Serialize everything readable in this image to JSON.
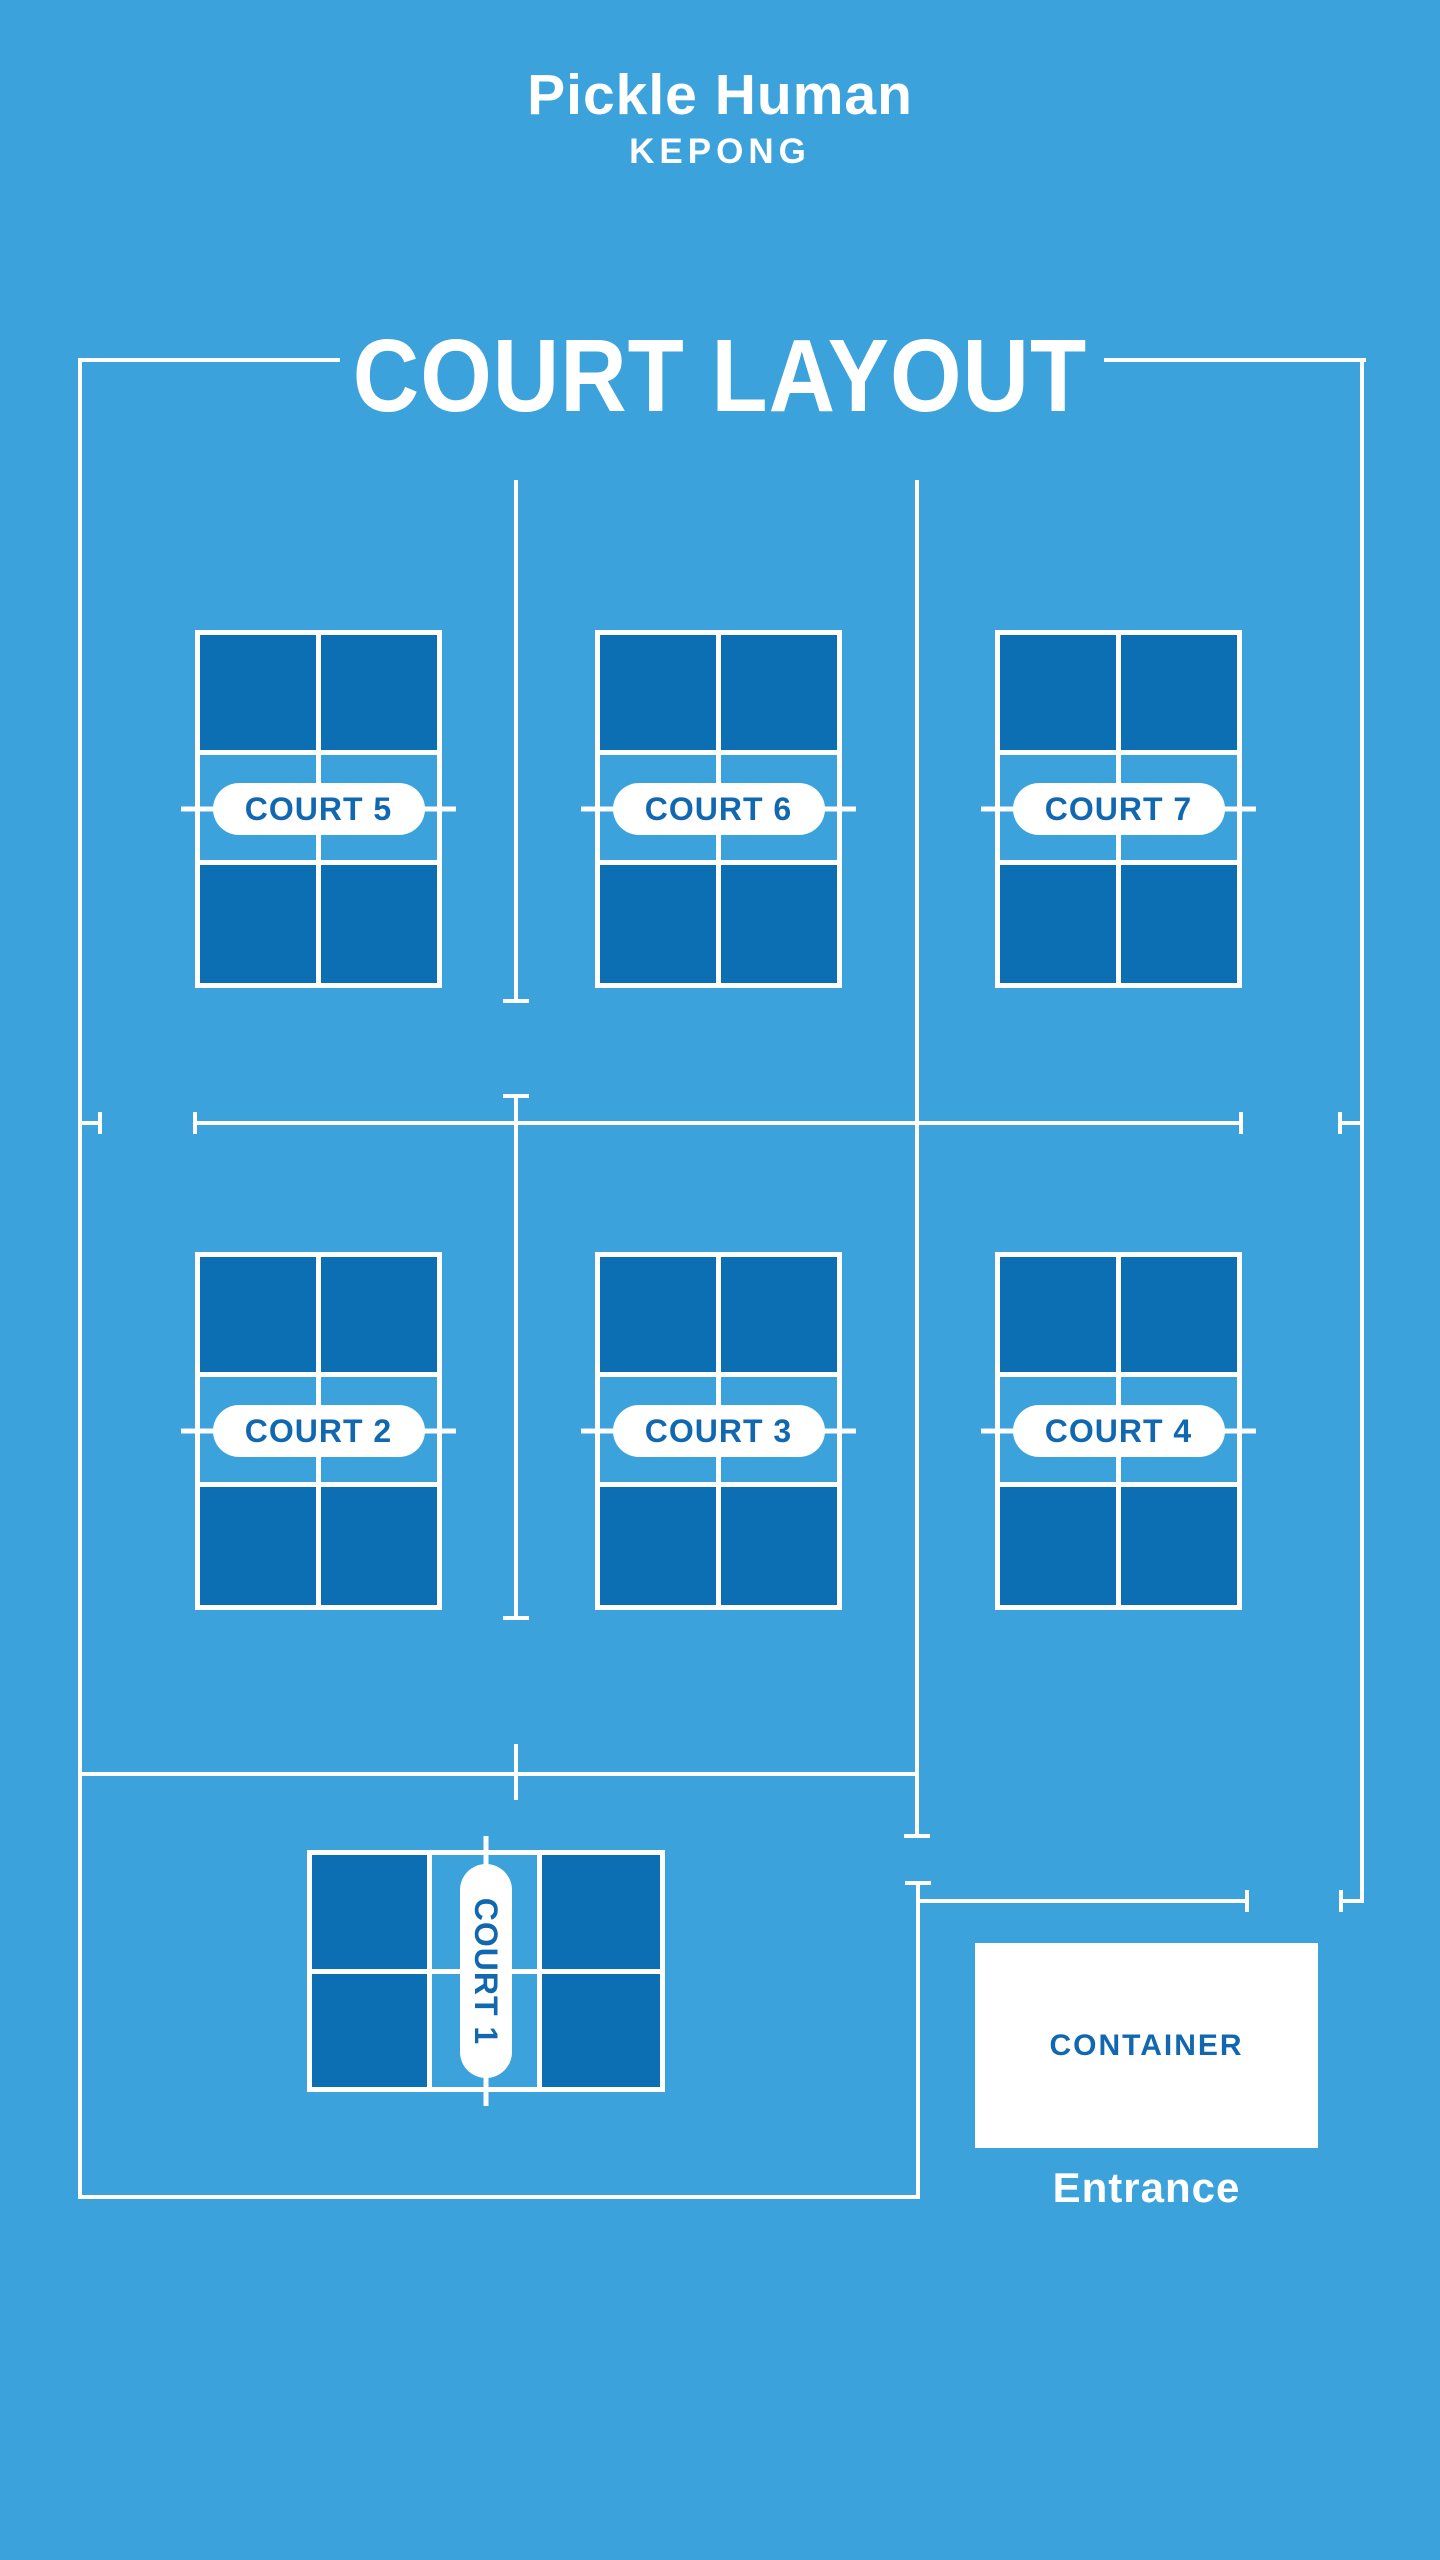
{
  "colors": {
    "background": "#3BA2DC",
    "court_dark": "#0C6FB3",
    "line_white": "#FFFFFF",
    "label_blue": "#1268B0"
  },
  "header": {
    "brand": "Pickle Human",
    "location": "KEPONG"
  },
  "heading": {
    "title": "COURT LAYOUT"
  },
  "courts": [
    {
      "id": "court-5",
      "label": "COURT 5",
      "orientation": "portrait"
    },
    {
      "id": "court-6",
      "label": "COURT 6",
      "orientation": "portrait"
    },
    {
      "id": "court-7",
      "label": "COURT 7",
      "orientation": "portrait"
    },
    {
      "id": "court-2",
      "label": "COURT 2",
      "orientation": "portrait"
    },
    {
      "id": "court-3",
      "label": "COURT 3",
      "orientation": "portrait"
    },
    {
      "id": "court-4",
      "label": "COURT 4",
      "orientation": "portrait"
    },
    {
      "id": "court-1",
      "label": "COURT 1",
      "orientation": "landscape"
    }
  ],
  "facilities": {
    "container": "CONTAINER",
    "entrance": "Entrance"
  }
}
